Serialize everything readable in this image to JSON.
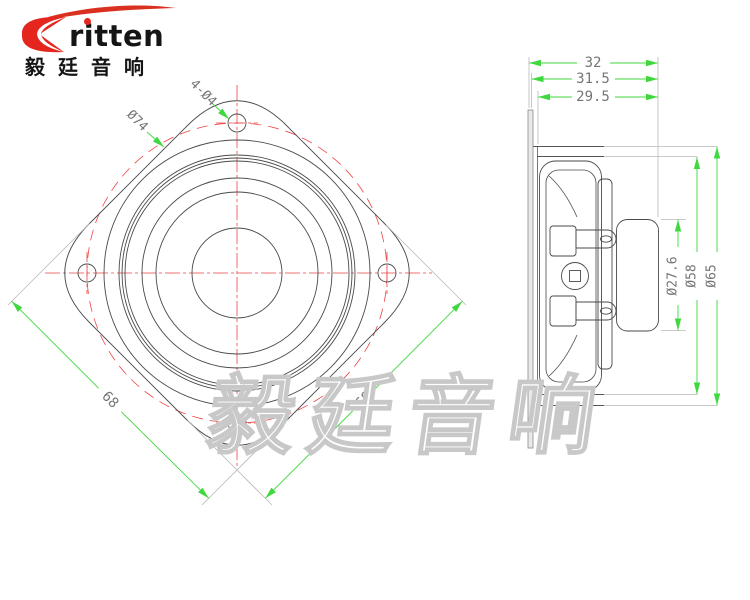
{
  "logo": {
    "brand": "ritten",
    "brand_cn": "毅廷音响"
  },
  "watermark": {
    "text": "毅廷音响"
  },
  "front_view": {
    "dims": {
      "mounting_holes": "4-Ø4",
      "bolt_circle": "Ø74",
      "square_side_left": "68",
      "square_side_right": "68"
    }
  },
  "side_view": {
    "dims": {
      "total_depth": "32",
      "depth_behind_front": "31.5",
      "body_depth": "29.5",
      "magnet_dia": "Ø27.6",
      "frame_dia": "Ø58",
      "flange_dia": "Ø65"
    }
  },
  "colors": {
    "dimension_green": "#3fd83f",
    "centerline_red": "#ee4444",
    "drawing_line": "#4a4a4a",
    "extension_grey": "#b9b9b9",
    "dim_text_grey": "#757575",
    "logo_red": "#e5261f",
    "watermark_grey": "#c8c8c8"
  }
}
